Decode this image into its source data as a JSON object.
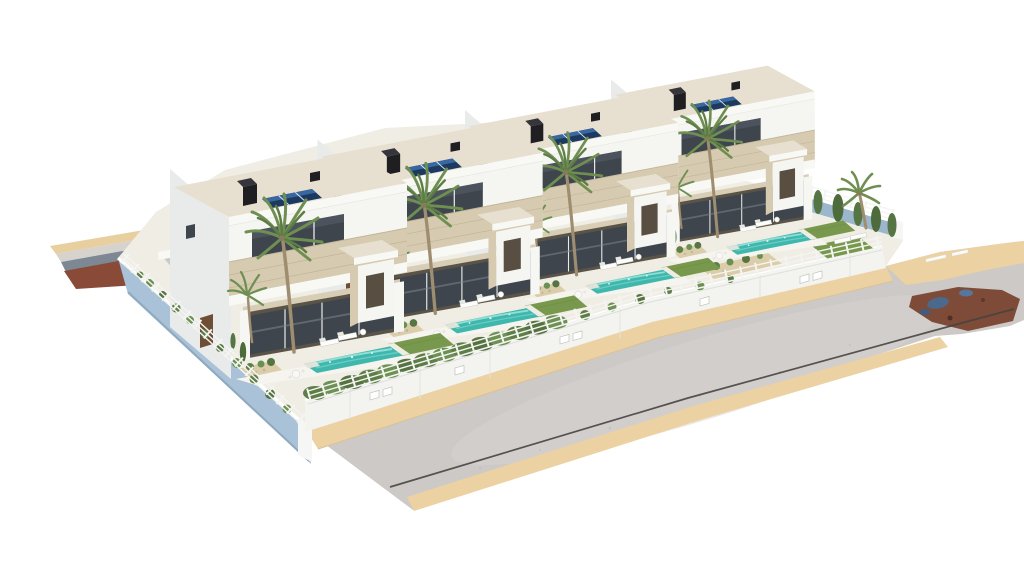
{
  "image": {
    "kind": "3D architectural exterior rendering",
    "subject": "Row of four modern two-storey white villas with private pools on a raised corner plot beside a curved street",
    "view": "elevated three-quarter aerial view on plain white background"
  },
  "development": {
    "villa_count": 4,
    "storeys_per_villa": 2,
    "private_pools": 4,
    "solar_panel_arrays": 4,
    "chimneys": 4,
    "palm_trees": 9,
    "cypress_trees": 14,
    "sun_loungers": 10,
    "villa_features": [
      "flat roof",
      "rooftop solar panels",
      "black chimney",
      "travertine balcony band",
      "covered terrace with glass doors",
      "entry porch volume",
      "lawn",
      "garden bed",
      "turquoise pool"
    ],
    "site_features": [
      "white perimeter fence with hedge",
      "white street wall with utility boxes",
      "light-blue retaining wall",
      "asphalt road with dark curb line",
      "sand-coloured sidewalks",
      "red-brown terrain patches",
      "back service road"
    ]
  },
  "colors": {
    "background": "#ffffff",
    "road": "#cdc9c7",
    "road_light": "#d8d4d2",
    "curb": "#474440",
    "sidewalk": "#ecd1a3",
    "sidewalk_edge": "#d9c296",
    "sand_band": "#e8cfa0",
    "pale_band": "#d6d3cf",
    "slate_band": "#7e8895",
    "red_patch": "#8a4a38",
    "terrain_red": "#7d4b38",
    "terrain_blue": "#4b698c",
    "platform": "#f0ede5",
    "pavement": "#f6f4ee",
    "blue_wall": "#a9c2d7",
    "blue_wall_shadow": "#8fa9bf",
    "street_wall": "#f3f3f0",
    "wall_cap": "#ffffff",
    "fence": "#f4f4f1",
    "fence_shadow": "#dedede",
    "hedge": "#5e7e48",
    "hedge_light": "#6d9154",
    "hedge_dark": "#557241",
    "lawn": "#78994d",
    "lawn_line": "#6c8c42",
    "pool_coping": "#efece3",
    "pool_water": "#3fb7ad",
    "pool_streak": "#9fe5dc",
    "pool_deep": "#74d2c8",
    "villa_white": "#f5f5f2",
    "villa_side": "#e8ebea",
    "fascia": "#f8f8f5",
    "roof_top": "#e7e0d0",
    "travertine": "#d6cab0",
    "travertine_line": "#c2b598",
    "glass": "#3e454d",
    "glass_light": "#565e68",
    "interior": "#5a5347",
    "ceiling": "#d8ceb5",
    "mullion": "#e9ebe9",
    "column": "#f6f6f3",
    "solar": "#1c3a5f",
    "solar_sheen": "#39679f",
    "solar_line": "#dde7f2",
    "chimney": "#1f1f22",
    "chimney_top": "#35353b",
    "palm_trunk": "#9f8d6f",
    "palm_frond": "#6f8f52",
    "palm_frond_dark": "#5d7c43",
    "palm_crown": "#8a7a5c",
    "cypress": "#4d6b3b",
    "cypress_light": "#567544",
    "bed": "#dbcda9",
    "tuft": "#5e7f47",
    "tuft_light": "#6b9054",
    "tuft_dark": "#567543",
    "court_floor": "#c8cac8",
    "door": "#6f4e36",
    "door_dark": "#584e42",
    "lounger": "#fcfcfa",
    "lounger_edge": "#c9c9c3",
    "lounger_edge2": "#e8e8e3",
    "pillar": "#f6f6f4",
    "inner_wall": "#9cb6cb",
    "pebble": "#beb5a1"
  }
}
